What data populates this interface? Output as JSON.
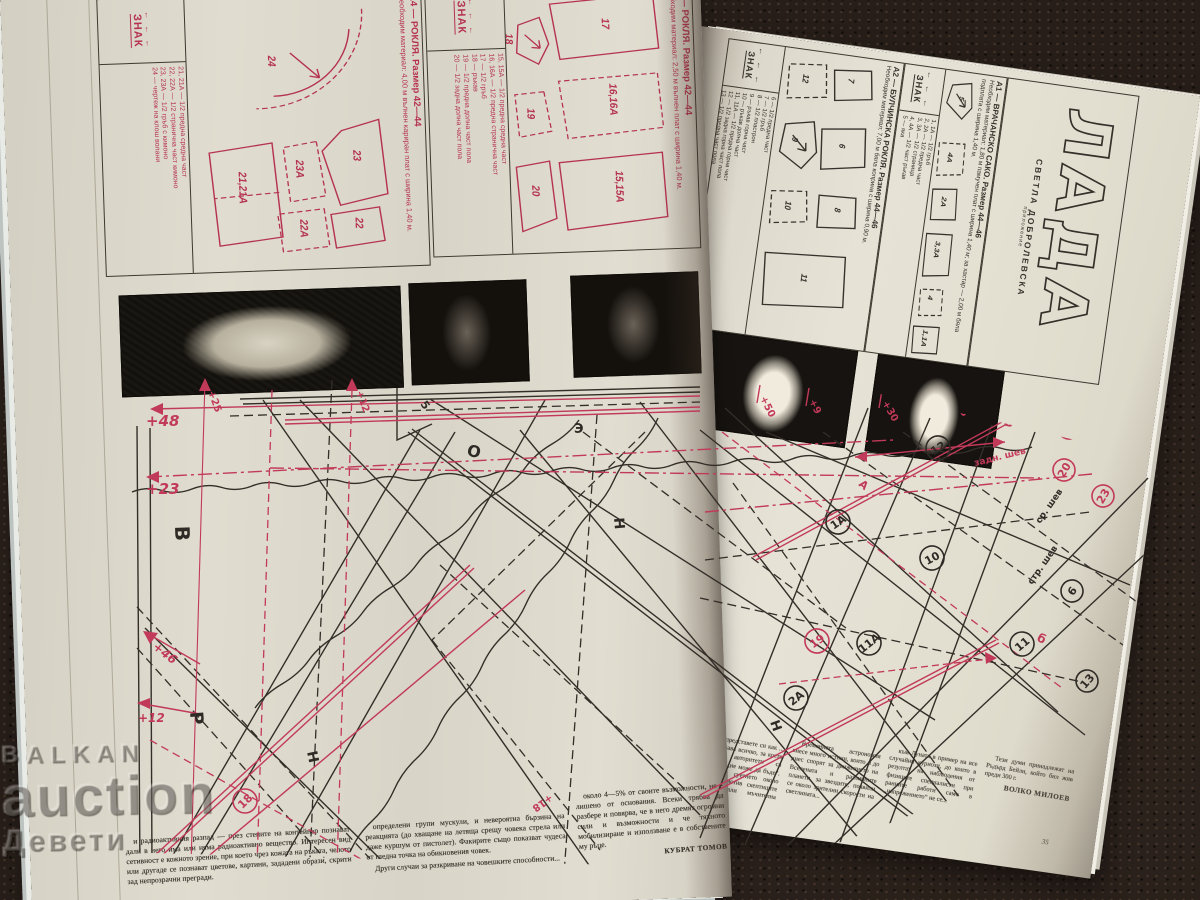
{
  "watermark": {
    "line1": "BALKAN",
    "line2": "auction",
    "line3": "Девети"
  },
  "magazine": {
    "title": "ЛАДА",
    "subtitle": "СВЕТЛА ДОБРОЛЕВСКА",
    "subtitle2": "приложение"
  },
  "panels": {
    "a4": {
      "title": "А4 — РОКЛЯ. Размер 42—44",
      "materials": "Необходим материал: 4,00 м вълнен кариран плат с ширина 1,40 м.",
      "znak": "ЗНАК",
      "znak_marks": "← ← ←",
      "legend": "21, 21А — 1/2 предна средна част\n22, 22А — 1/2 странична част кимоно\n23, 23А — 1/2 гръб с кимоно\n24 — чертеж на клош волани",
      "pieces": [
        "23",
        "23А",
        "22А",
        "22",
        "24",
        "21,21А"
      ]
    },
    "a3": {
      "title": "А3 — РОКЛЯ. Размер 42—44",
      "materials": "Необходим материал: 2,50 м вълнен плат с ширина 1,40 м.",
      "znak": "ЗНАК",
      "znak_marks": "← ← ←",
      "legend": "15, 15А — 1/2 предна средна част\n16, 16А — 1/2 предна странична част\n17 — 1/2 гръб\n18 — ръкав\n19 — 1/2 предна долна част пола\n20 — 1/2 задна долна част пола",
      "pieces": [
        "20",
        "18",
        "19",
        "17",
        "16,16А",
        "15,15А"
      ]
    },
    "a2": {
      "title": "А2 — БУЛЧИНСКА РОКЛЯ. Размер 44—46",
      "materials": "Необходим материал: 7,00 м бяла коприна с ширина 0,90 м.",
      "znak": "ЗНАК",
      "znak_marks": "← ← ←",
      "legend": "6 — 1/2 предна част\n7 — 1/2 гръб\n8 — 1/2 пластрон\n9 — ръкав горна част\n10 — ръкав долна част\n11, 11А — 1/2 предна горна част\n12 — 1/2 задна горна част пола\n13 — 1/2 предна част пола",
      "pieces": [
        "7",
        "12",
        "6",
        "9",
        "10",
        "8",
        "11"
      ]
    },
    "a1": {
      "title": "А1 — ВРАЧАНСКО САКО. Размер 44—46",
      "materials": "Необходим материал: 1,80 м памучен плат с ширина 1,40 м; за хастар — 2,00 м бяла подплата с ширина 1,40 м.",
      "znak": "ЗНАК",
      "znak_marks": "← ← ←",
      "legend": "1, 1А — 1/2 гръб\n2, 2А — 1/2 предна част\n3, 3А — 1/2 страница\n4, 4А — 1/2 част ръкав\n5 — яка",
      "pieces": [
        "5",
        "4А",
        "2А",
        "3,3А",
        "4",
        "1,1А"
      ]
    }
  },
  "pattern_sheet": {
    "margin_labels": [
      "+48",
      "+23",
      "+46",
      "+12",
      "+25",
      "+12"
    ],
    "top_labels": [
      "+50",
      "+9",
      "+30",
      "+55"
    ],
    "seam_labels": [
      "задн. шев",
      "ср. шев",
      "стр. шев"
    ],
    "letters": [
      "В",
      "О",
      "Э",
      "Н",
      "Р",
      "Н",
      "Н",
      "А",
      "Б",
      "б",
      "5",
      "+18"
    ],
    "circled": [
      "12",
      "1А",
      "10",
      "19",
      "2А",
      "11А",
      "11",
      "6",
      "25",
      "20",
      "23",
      "13",
      "18"
    ]
  },
  "article_left": {
    "col1": "и радиоактивния разпад — през стените на контейнер познават дали в него има или няма радиоактивно вещество. Интересен вид сетивност е кожното зрение, при което чрез кожата на ръката, челото или другаде се познават цветове, картини, зададени образи, скрити зад непрозрачни прегради.",
    "col2a": "определени групи мускули, и невероятна бързина на реакцията (до хващане на летяща срещу човека стрела или даже куршум от пистолет). Факирите също показват чудеса от гледна точка на обикновения човек.",
    "col2b": "Други случаи за разкриване на човешки­те способности...",
    "col3": "около 4—5% от своите възможности, не е лишено от основания. Всеки трябва да разбере и повярва, че в него дремят огромни сили и възможности и че тяхното мобилизиране и използване е в собствените му ръце.",
    "author": "КУБРАТ ТОМОВ"
  },
  "article_right": {
    "col1": "Хайде, представете си как ... до вас изучава всичко, за което навремето авторитети са обявили, че „не може да бъде“. Например в суетнето около първия локомотив скептиците са предричали мъчителна смърт...",
    "col2": "Временната астрономия внесе много истини, които и до днес спорят за движението на Вселената и различните планети, за звездите, появили се около зрителни скорости на светлината...",
    "col3": "към Луната в пример на все случайни куриози, до които в резултат на наблюдения от физиците специалисти при ранните работи само в „напрежението“ не се...",
    "col4": "Тези думи принадлежат на Ръдърд Бейли, който бил жив преди 300 г.",
    "author": "ВОЛКО МИЛОЕВ",
    "page_number": "35"
  }
}
